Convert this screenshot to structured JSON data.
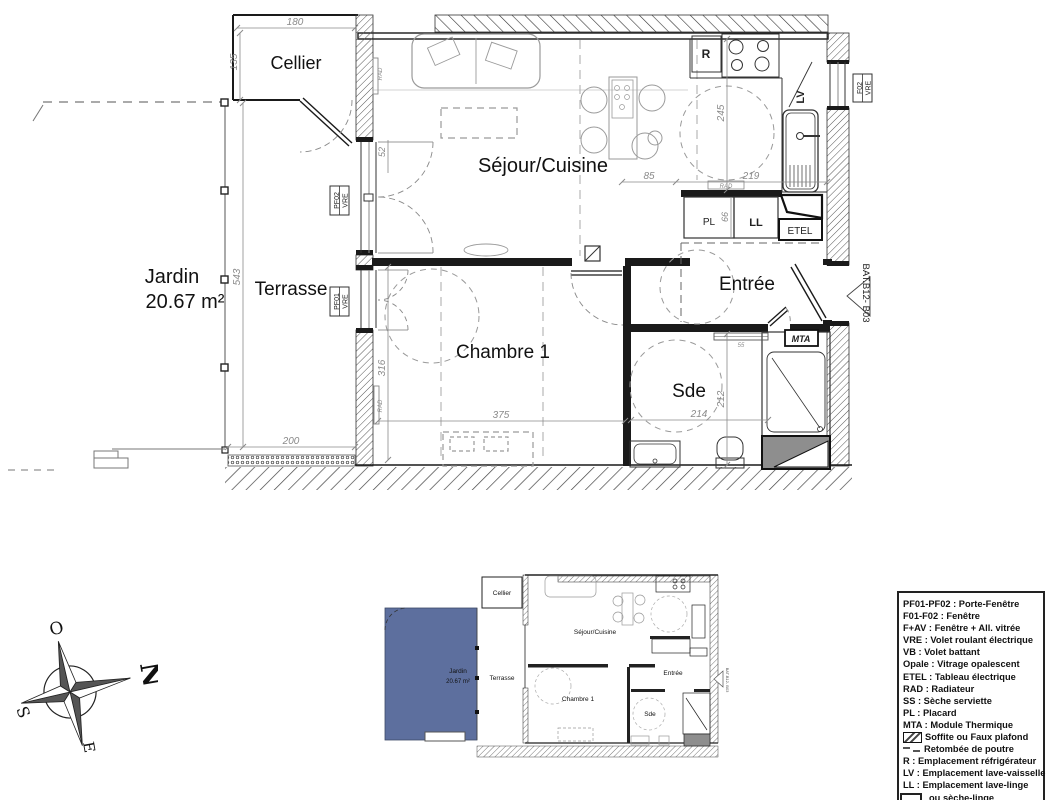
{
  "plan": {
    "rooms": {
      "cellier": "Cellier",
      "sejour": "Séjour/Cuisine",
      "jardin": "Jardin",
      "jardin_area": "20.67 m²",
      "terrasse": "Terrasse",
      "chambre": "Chambre 1",
      "entree": "Entrée",
      "sde": "Sde"
    },
    "dims": {
      "d180": "180",
      "d135": "135",
      "d543": "543",
      "d200": "200",
      "d375": "375",
      "d316": "316",
      "d52": "52",
      "d245": "245",
      "d85": "85",
      "d219": "219",
      "d66": "66",
      "d214": "214",
      "d212": "212",
      "d55": "55"
    },
    "tags": {
      "pf02": "PF02",
      "pf01": "PF01",
      "f02": "F02",
      "vre": "VRE",
      "r": "R",
      "lv": "LV",
      "pl": "PL",
      "ll": "LL",
      "etel": "ETEL",
      "mta": "MTA",
      "rad": "RAD",
      "bat": "BAT.B12- B03"
    }
  },
  "compass": {
    "o": "O",
    "n": "N",
    "s": "S",
    "e": "E"
  },
  "legend": {
    "items": [
      "PF01-PF02 : Porte-Fenêtre",
      "F01-F02 : Fenêtre",
      "F+AV : Fenêtre + All. vitrée",
      "VRE : Volet roulant électrique",
      "VB : Volet battant",
      "Opale : Vitrage opalescent",
      "ETEL : Tableau électrique",
      "RAD : Radiateur",
      "SS : Sèche serviette",
      "PL : Placard",
      "MTA : Module Thermique",
      "Soffite ou Faux plafond",
      "Retombée de poutre",
      "R : Emplacement réfrigérateur",
      "LV : Emplacement lave-vaisselle",
      "LL : Emplacement lave-linge",
      "ou sèche-linge"
    ]
  },
  "colors": {
    "jardin_fill": "#5d6f9e"
  }
}
